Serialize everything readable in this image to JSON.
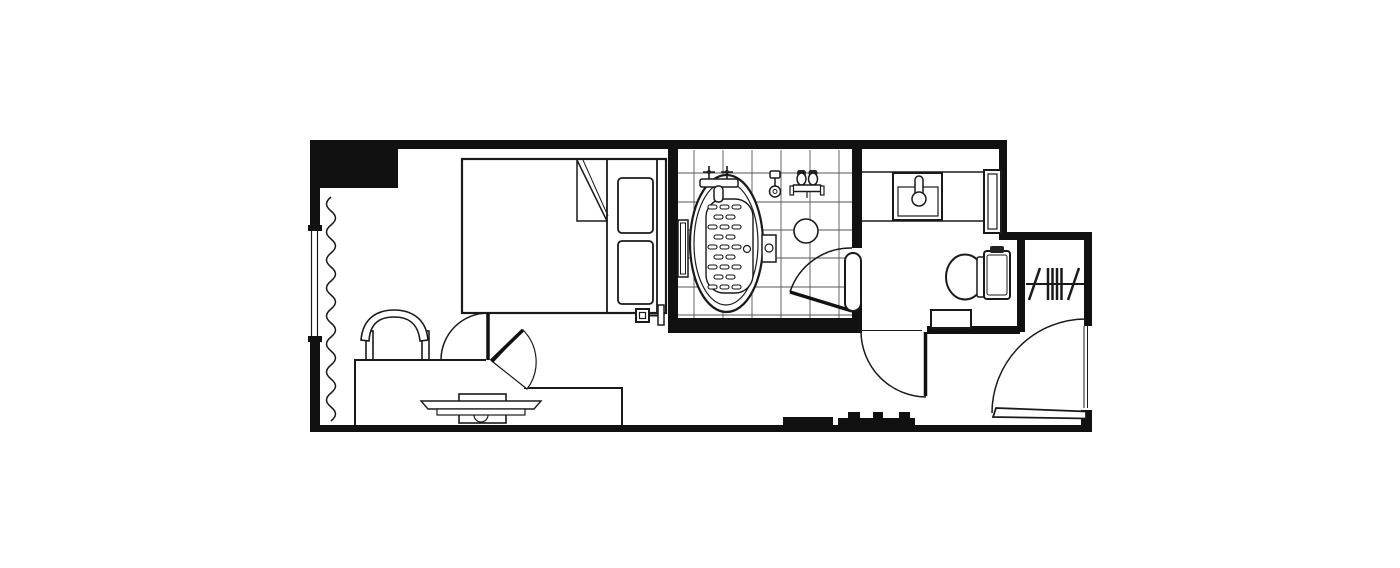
{
  "plan": {
    "title": "Hotel guest room floor plan",
    "background_color": "#ffffff",
    "wall_color": "#111111",
    "line_color": "#1a1a1a",
    "tile_line_color": "#555555",
    "rooms": [
      {
        "id": "bedroom",
        "label": "Bedroom"
      },
      {
        "id": "bathroom",
        "label": "Bathroom"
      },
      {
        "id": "washroom",
        "label": "Washroom with vanity and toilet"
      },
      {
        "id": "closet",
        "label": "Closet"
      },
      {
        "id": "entry",
        "label": "Entry corridor"
      }
    ],
    "fixtures": {
      "walls": "Walls",
      "window": "Window",
      "curtain": "Curtain",
      "bed": "Double bed",
      "pillows": "Pillows",
      "blanket_fold": "Folded blanket corner",
      "headboard": "Headboard",
      "bedside_control": "Bedside wall control",
      "chair": "Desk chair",
      "desk": "Desk counter",
      "tv": "Television on swivel base",
      "pivot_partition": "Pivoting partition door",
      "tile_floor": "Tiled bathroom floor",
      "bathtub": "Oval bathtub with anti-slip mat",
      "tub_faucet": "Bathtub faucet with cross handles",
      "wall_caddy": "Bath wall caddy",
      "tub_control": "Bath control box",
      "hand_shower": "Hand shower",
      "shower_mixer": "Shower mixer valve",
      "shower_stool": "Shower stool",
      "bathroom_door": "Bathroom swing door",
      "door_panel": "Door panel towel bar",
      "vanity_counter": "Vanity counter",
      "sink": "Vanity sink with faucet",
      "vanity_shelf": "Vanity end shelf",
      "toilet": "Toilet",
      "toilet_step": "Step bin beside toilet",
      "toilet_door": "Toilet room swing door",
      "closet_rail": "Closet rail with hangers",
      "entry_door": "Entry swing door",
      "threshold_blocks": "Corridor threshold blocks"
    }
  }
}
